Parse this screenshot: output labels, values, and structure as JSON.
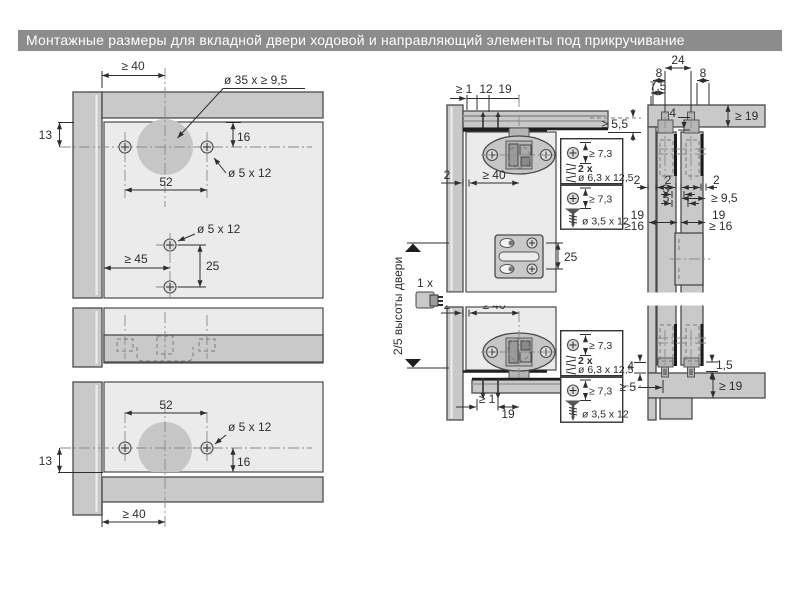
{
  "title": "Монтажные размеры для вкладной двери ходовой и направляющий элементы под прикручивание",
  "colors": {
    "titlebar": "#8c8c8c",
    "panel": "#c9c9c9",
    "door": "#ebebeb",
    "cup": "#c6c6c6",
    "line": "#2e2e2e"
  },
  "front_view": {
    "offset_40": "≥ 40",
    "cup_label": "ø 35 x ≥ 9,5",
    "d13": "13",
    "d16": "16",
    "screw_label": "ø 5 x 12",
    "d52": "52",
    "d45": "≥ 45",
    "d25": "25"
  },
  "section_view": {
    "d1": "≥ 1",
    "d12": "12",
    "d19": "19",
    "d55": "≥ 5,5",
    "d2": "2",
    "d40": "≥ 40",
    "d25": "25",
    "qty": "1 x",
    "height_label": "2/5 высоты двери"
  },
  "screw_box_a": {
    "head": "≥ 7,3",
    "qty": "2 x",
    "size": "ø 6,3 x 12,5"
  },
  "screw_box_b": {
    "head": "≥ 7,3",
    "size": "ø 3,5 x 12"
  },
  "side_view": {
    "d24": "24",
    "d8": "8",
    "d75": "7,5",
    "d4": "4",
    "d19": "≥ 19",
    "d2": "2",
    "d3": "3",
    "d5": "5",
    "d95": "≥ 9,5",
    "d19b": "19",
    "d16": "≥16",
    "d16r": "≥ 16",
    "d5b": "≥ 5",
    "d15": "1,5"
  }
}
